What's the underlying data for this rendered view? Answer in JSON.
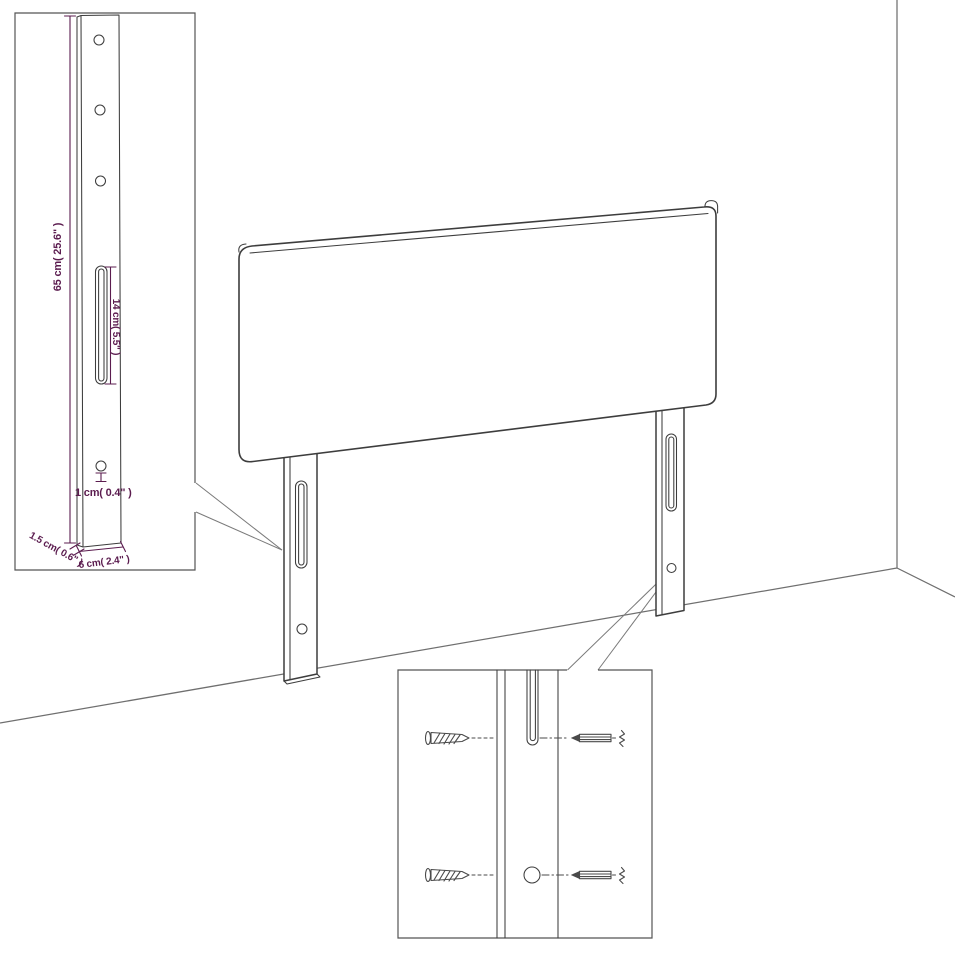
{
  "colors": {
    "background": "#ffffff",
    "outline": "#3d3d3d",
    "room_line": "#6f6f6f",
    "inset_border": "#555555",
    "dimension": "#5b1c4f",
    "callout_line": "#7a7a7a",
    "screw": "#4a4a4a"
  },
  "labels": {
    "leg_height": "65 cm( 25.6\" )",
    "slot_length": "14 cm( 5.5\" )",
    "hole_diameter": "1 cm( 0.4\" )",
    "leg_thickness": "1.5 cm( 0.6\" )",
    "leg_width": "6 cm( 2.4\" )"
  }
}
